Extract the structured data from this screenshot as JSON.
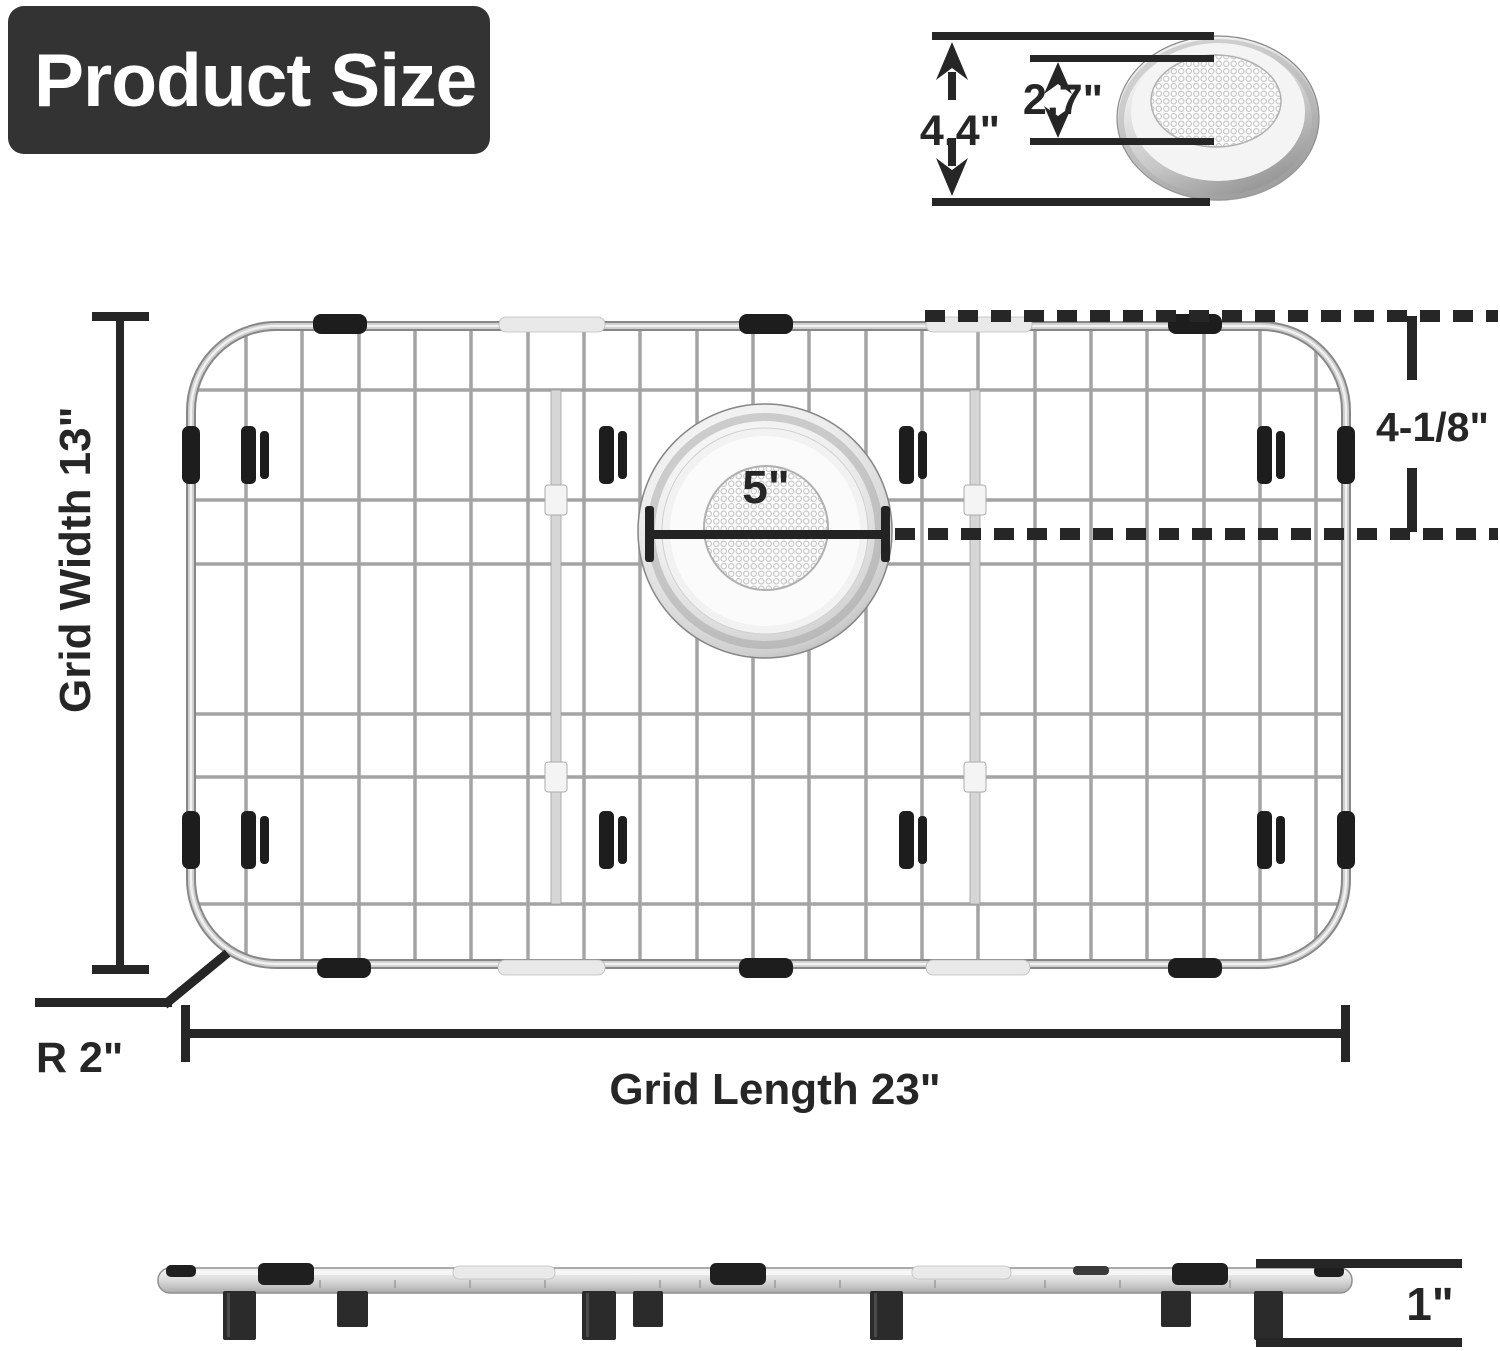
{
  "title": {
    "text": "Product Size"
  },
  "top_view": {
    "description": "stainless sink grid top view",
    "labels": {
      "grid_width": "Grid Width 13\"",
      "grid_length": "Grid Length 23\"",
      "corner_radius": "R 2\"",
      "drain_opening_diameter": "5\"",
      "drain_offset_from_top": "4-1/8\""
    }
  },
  "strainer_detail": {
    "description": "drain strainer detail view",
    "labels": {
      "outer_diameter": "4.4\"",
      "mesh_diameter": "2.7\""
    }
  },
  "side_view": {
    "description": "sink grid side profile with feet",
    "labels": {
      "height_with_feet": "1\""
    }
  },
  "colors": {
    "title_bg": "#333333",
    "title_text": "#ffffff",
    "dimension_lines": "#262626",
    "wire": "#a4a4a4",
    "frame_dark": "#878787",
    "frame_light": "#f2f2f2",
    "rubber_black": "#1d1d1d",
    "chrome_sleeve": "#e9e9e9",
    "support_bar": "#d6d6d6"
  }
}
